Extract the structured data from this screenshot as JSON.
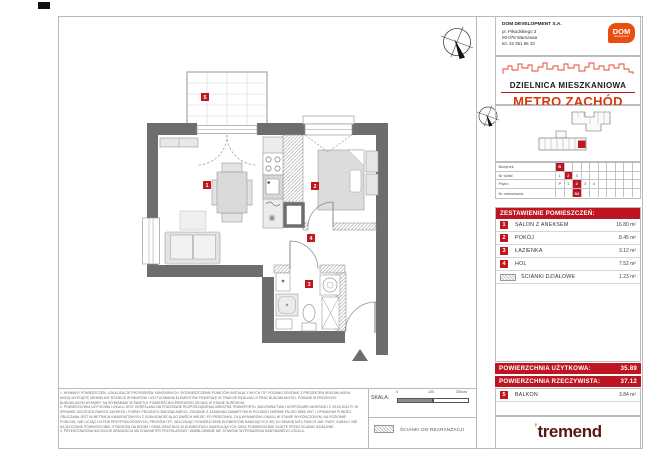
{
  "header": {
    "company": "DOM DEVELOPMENT S.A.",
    "address1": "pl. Piłsudskiego 3",
    "address2": "00-078 Warszawa",
    "phone": "tel. 22 351 66 33",
    "logo": "DOM",
    "logo_sub": "development",
    "estate": "DZIELNICA MIESZKANIOWA",
    "project": "METRO ZACHÓD"
  },
  "unit_table": {
    "rows": [
      {
        "label": "Budynek",
        "cells": [
          "B",
          "",
          "",
          "",
          "",
          "",
          "",
          "",
          "",
          ""
        ],
        "highlight": 0
      },
      {
        "label": "Nr klatki",
        "cells": [
          "1",
          "2",
          "3",
          "",
          "",
          "",
          "",
          "",
          "",
          ""
        ],
        "highlight": 1
      },
      {
        "label": "Piętro",
        "cells": [
          "P",
          "1",
          "2",
          "3",
          "4",
          "",
          "",
          "",
          "",
          ""
        ],
        "highlight": 2
      },
      {
        "label": "Nr mieszkania",
        "cells": [
          "",
          "",
          "54",
          "",
          "",
          "",
          "",
          "",
          "",
          ""
        ],
        "highlight": 2
      }
    ]
  },
  "rooms": {
    "title": "ZESTAWIENIE POMIESZCZEŃ:",
    "items": [
      {
        "num": "1",
        "name": "SALON Z ANEKSEM",
        "area": "16.80 m²"
      },
      {
        "num": "2",
        "name": "POKÓJ",
        "area": "8.45 m²"
      },
      {
        "num": "3",
        "name": "ŁAZIENKA",
        "area": "3.12 m²"
      },
      {
        "num": "4",
        "name": "HOL",
        "area": "7.52 m²"
      },
      {
        "num": "",
        "name": "ŚCIANKI DZIAŁOWE",
        "area": "1.23 m²",
        "swatch": true
      }
    ]
  },
  "totals": {
    "usable_label": "POWIERZCHNIA UŻYTKOWA:",
    "usable_value": "35.89",
    "real_label": "POWIERZCHNIA RZECZYWISTA:",
    "real_value": "37.12",
    "balcony": {
      "num": "5",
      "name": "BALKON",
      "area": "3.84 m²"
    }
  },
  "plan": {
    "markers": {
      "salon": "1",
      "pokoj": "2",
      "lazienka": "3",
      "hol": "4",
      "balkon": "5"
    }
  },
  "scale": {
    "label": "SKALA:",
    "t0": "0",
    "t1": "100",
    "t2": "200cm"
  },
  "legend": {
    "rearrange": "ŚCIANKI DO REARANŻACJI"
  },
  "footer": {
    "logo": "tremend",
    "accent": "’"
  },
  "notes": [
    "1. WYMIARY POMIESZCZEŃ, LOKALIZACJE PRZYBORÓW SANITARNYCH, ROZMIESZCZENIE PUNKTÓW INSTALACYJNYCH ITP. PODANO ZGODNIE Z PROJEKTEM BUDOWLANYM. MOGĄ WYSTĄPIĆ NIEWIELKIE RÓŻNICE WYMIARÓW I USYTUOWANIA ELEMENTÓW POWSTAŁE W TRAKCIE REALIZACJI PRAC BUDOWLANYCH. PODANE W PROJEKCIE BUDOWLANYM WYMIARY SĄ WYMIARAMI W ŚWIETLE POWIERZCHNI PRZEGRÓD (ŚCIAN) W STANIE SUROWYM.",
    "2. POWIERZCHNIA UŻYTKOWA LOKALU JEST OKREŚLANA NA PODSTAWIE ROZPORZĄDZENIA MINISTRA TRANSPORTU, BUDOWNICTWA I GOSPODARKI MORSKIEJ Z 25.04.2012 R. W SPRAWIE SZCZEGÓŁOWEGO ZAKRESU I FORMY PROJEKTU BUDOWLANEGO, ZGODNIE Z ZASADAMI ZAWARTYMI W POLSKIEJ NORMIE PN-ISO 9836:1997 I OPISANYMI PONIŻEJ. OBLICZANA JEST W METRACH KWADRATOWYCH Z DOKŁADNOŚCIĄ DO DWÓCH MIEJSC PO PRZECINKU, DLA WYMIARÓW LOKALU W STANIE WYKOŃCZONYM, NA POZIOMIE PODŁOGI, NIE LICZĄC LISTEW PRZYPODŁOGOWYCH, PROGÓW ITP., WLICZAJĄC POWIERZCHNIE ELEMENTÓW NADAJĄCYCH SIĘ DO DEMONTAŻU TAKICH JAK: RURY, KANAŁY. NIE SĄ WLICZANE POWIERZCHNIE OTWORÓW NA DRZWI I OKNA ORAZ NISZ W ELEMENTACH ZAMYKAJĄCYCH ORAZ POWIERZCHNIE ZAJĘTE PRZEZ ŚCIANKI DZIAŁOWE.",
    "3. PRZEDSTAWIONA NA RZUCIE ARANŻACJA MA CHARAKTER PRZYKŁADOWY. UMEBLOWANIE NIE STANOWI WYPOSAŻENIA NABYWANEGO LOKALU."
  ]
}
